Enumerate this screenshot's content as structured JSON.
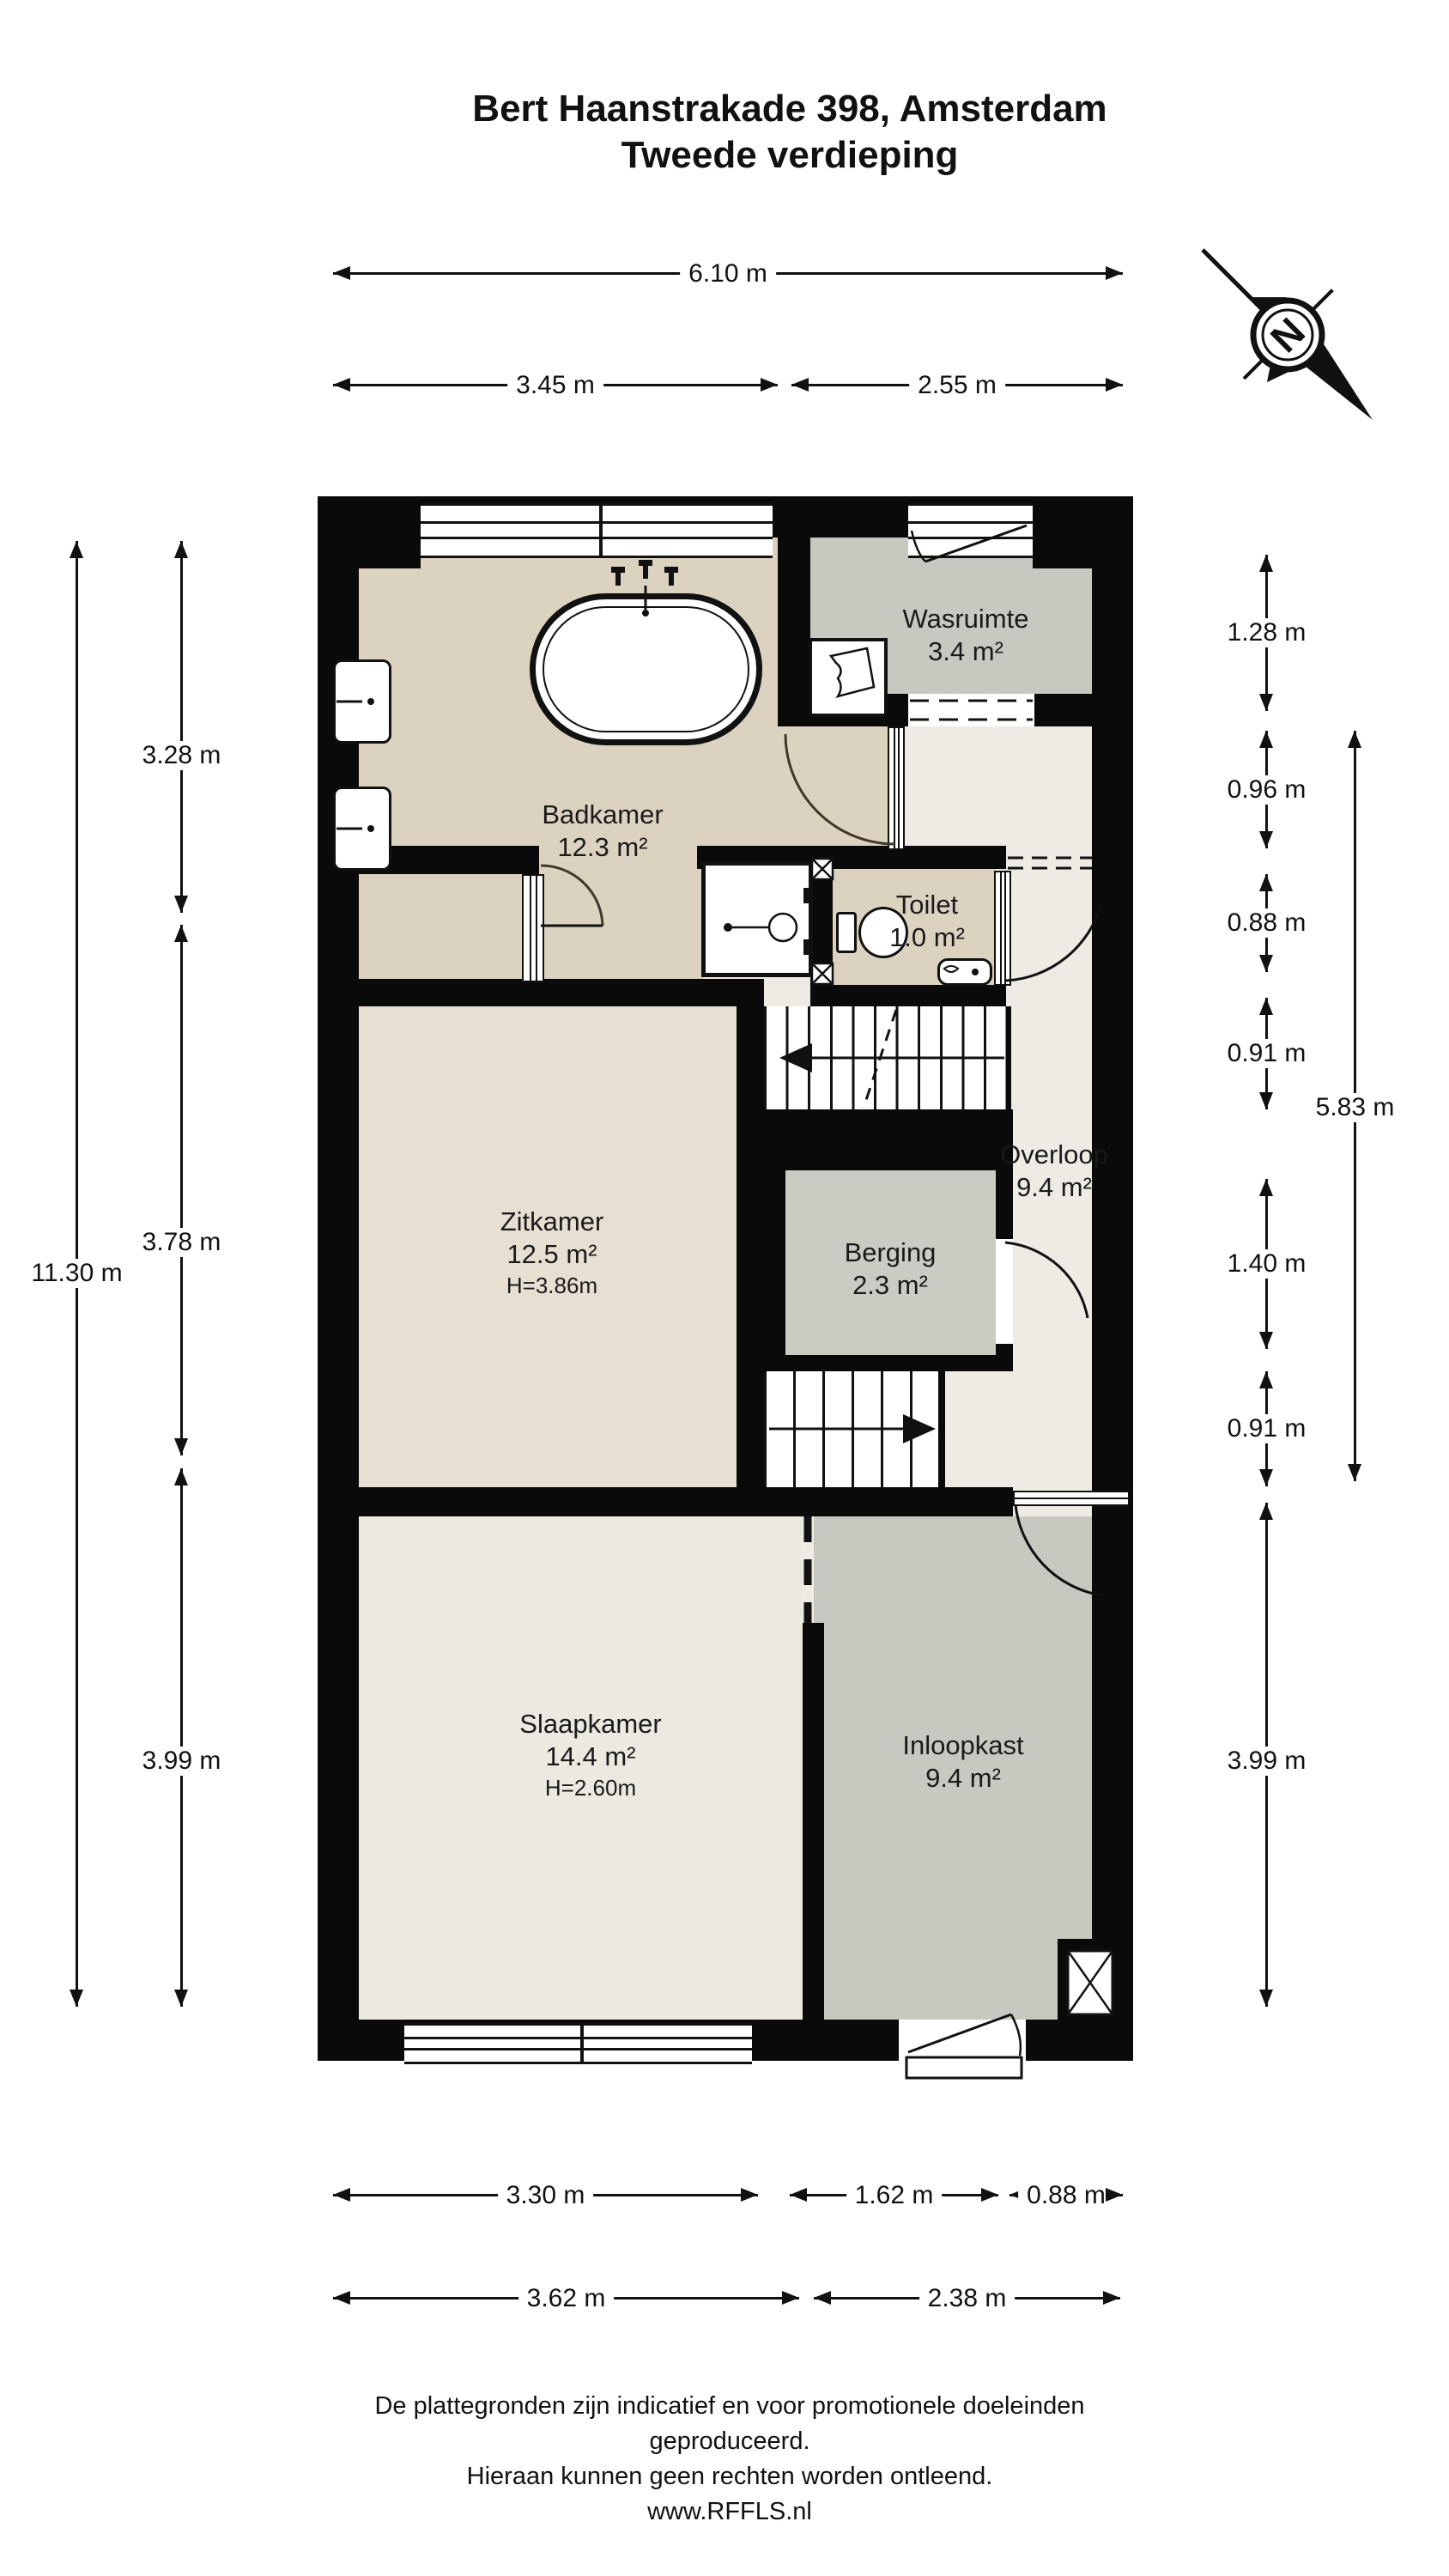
{
  "title": {
    "line1": "Bert Haanstrakade 398, Amsterdam",
    "line2": "Tweede verdieping"
  },
  "compass": {
    "label": "N"
  },
  "rooms": {
    "badkamer": {
      "name": "Badkamer",
      "area": "12.3 m²"
    },
    "wasruimte": {
      "name": "Wasruimte",
      "area": "3.4 m²"
    },
    "toilet": {
      "name": "Toilet",
      "area": "1.0 m²"
    },
    "overloop": {
      "name": "Overloop",
      "area": "9.4 m²"
    },
    "zitkamer": {
      "name": "Zitkamer",
      "area": "12.5 m²",
      "height": "H=3.86m"
    },
    "berging": {
      "name": "Berging",
      "area": "2.3 m²"
    },
    "slaapkamer": {
      "name": "Slaapkamer",
      "area": "14.4 m²",
      "height": "H=2.60m"
    },
    "inloopkast": {
      "name": "Inloopkast",
      "area": "9.4 m²"
    }
  },
  "dimensions": {
    "top": {
      "full": "6.10 m",
      "left": "3.45 m",
      "right": "2.55 m"
    },
    "left": {
      "seg1": "3.28 m",
      "seg2": "3.78 m",
      "seg3": "3.99 m",
      "total": "11.30 m"
    },
    "right": {
      "seg1": "1.28 m",
      "seg2": "0.96 m",
      "seg3": "0.88 m",
      "seg4": "0.91 m",
      "seg5": "1.40 m",
      "seg6": "0.91 m",
      "seg7": "3.99 m",
      "span": "5.83 m"
    },
    "bottom": {
      "row1a": "3.30 m",
      "row1b": "1.62 m",
      "row1c": "0.88 m",
      "row2a": "3.62 m",
      "row2b": "2.38 m"
    }
  },
  "footer": {
    "line1": "De plattegronden zijn indicatief en voor promotionele doeleinden geproduceerd.",
    "line2": "Hieraan kunnen geen rechten worden ontleend.",
    "line3": "www.RFFLS.nl"
  },
  "colors": {
    "wall": "#0a0a0a",
    "dimension": "#111111",
    "bathroom_floor": "#dcd2c0",
    "utility_floor": "#c6c9c0",
    "storage_floor": "#c9ccc3",
    "landing_floor": "#edebe4",
    "living_floor": "#e7e0d2",
    "bedroom_floor": "#ece9e0",
    "closet_floor": "#c6c9c0"
  },
  "icons": {
    "compass": "compass-north-icon",
    "washing_machine": "washing-machine-icon",
    "bathtub": "bathtub-icon",
    "shower": "shower-icon",
    "toilet_fixture": "toilet-icon",
    "sink": "sink-icon",
    "stairs": "stairs-icon",
    "vent_shaft": "shaft-x-icon"
  }
}
